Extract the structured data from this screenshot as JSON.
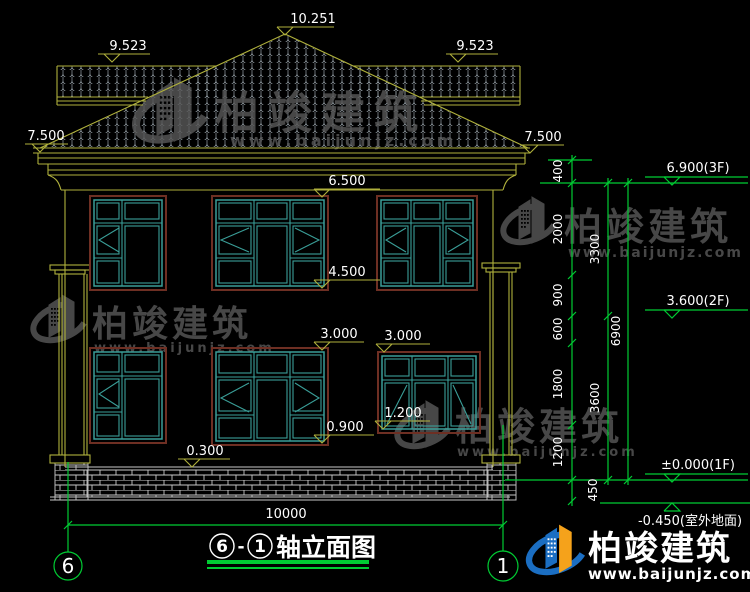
{
  "drawing": {
    "marks": {
      "m_10251": "10.251",
      "m_9523_l": "9.523",
      "m_9523_r": "9.523",
      "m_7500_l": "7.500",
      "m_7500_r": "7.500",
      "m_6500": "6.500",
      "m_4500": "4.500",
      "m_3000_a": "3.000",
      "m_3000_b": "3.000",
      "m_0900": "0.900",
      "m_1200": "1.200",
      "m_0300": "0.300"
    },
    "chain_small": [
      "400",
      "2000",
      "900",
      "600",
      "1800",
      "1200",
      "450"
    ],
    "chain_mid": [
      "3300",
      "3600"
    ],
    "chain_total": "6900",
    "levels": {
      "f3": "6.900(3F)",
      "f2": "3.600(2F)",
      "f1": "±0.000(1F)",
      "ground": "-0.450(室外地面)"
    },
    "bottom": {
      "overall": "10000"
    },
    "axes": {
      "left": "6",
      "right": "1"
    },
    "title": {
      "bubble_left": "6",
      "dash": "-",
      "bubble_right": "1",
      "label": "轴立面图"
    }
  },
  "watermark": {
    "brand": "柏竣建筑",
    "site": "www.baijunjz.com"
  },
  "footer_logo": {
    "brand": "柏竣建筑",
    "site": "www.baijunjz.com"
  },
  "colors": {
    "background": "#000000",
    "cad_yellow": "#b0b13c",
    "cad_green": "#00cc33",
    "window_teal": "#3a9e98",
    "window_frame_red": "#6e2f23",
    "tile_gray": "#97a1a8",
    "brick_gray": "#c9c9c9",
    "text_white": "#ffffff",
    "watermark_gray": "#575757",
    "logo_blue": "#1b6ec2",
    "logo_orange": "#f5a21b"
  }
}
